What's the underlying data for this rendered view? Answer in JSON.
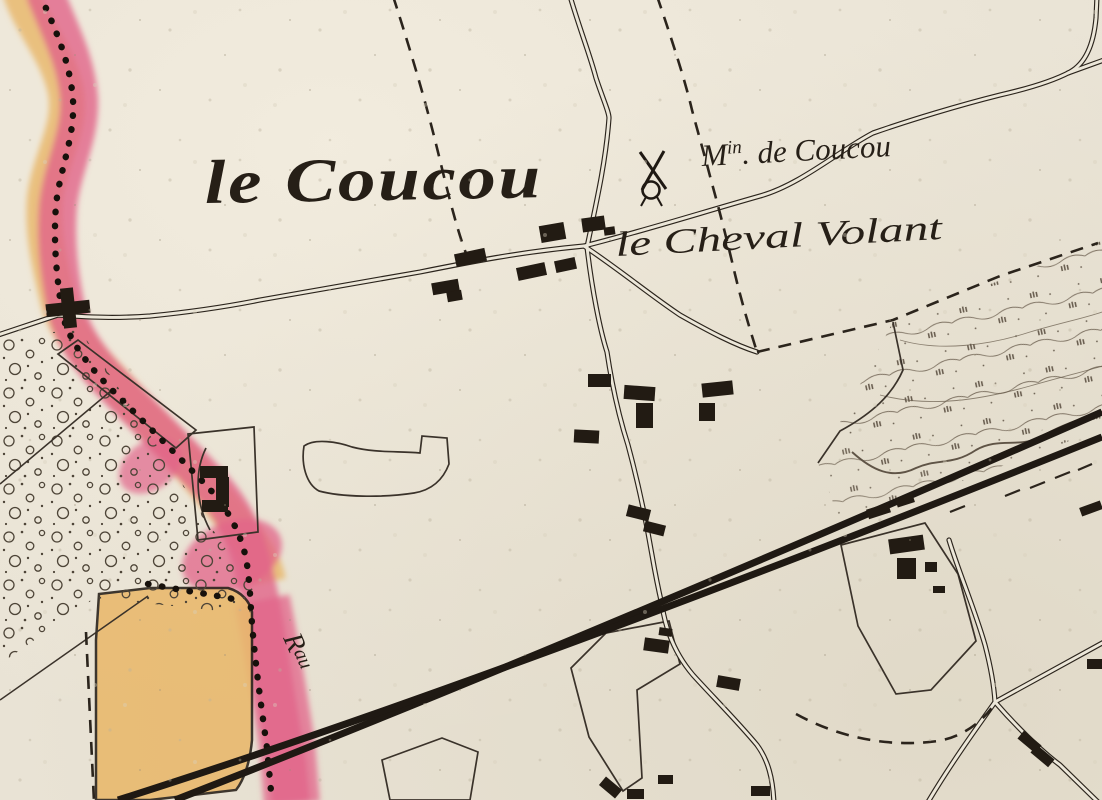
{
  "map": {
    "colors": {
      "paper": "#e9e3d5",
      "ink": "#2b241c",
      "pink": "#e1648a",
      "orange": "#e9b96e",
      "building": "#221b13"
    },
    "labels": {
      "locality": "le Coucou",
      "mill_prefix": "M",
      "mill_sup": "in",
      "mill_suffix": ". de Coucou",
      "hamlet": "le Cheval Volant",
      "stream_prefix": "R",
      "stream_sup": "au"
    },
    "symbols": [
      {
        "name": "windmill-icon"
      }
    ],
    "buildings": [
      [
        46,
        302,
        44,
        13,
        -6
      ],
      [
        62,
        288,
        13,
        40,
        -6
      ],
      [
        432,
        281,
        27,
        12,
        -10
      ],
      [
        447,
        291,
        15,
        10,
        -10
      ],
      [
        455,
        251,
        31,
        13,
        -12
      ],
      [
        517,
        265,
        29,
        13,
        -12
      ],
      [
        555,
        259,
        21,
        12,
        -12
      ],
      [
        540,
        224,
        25,
        17,
        -10
      ],
      [
        582,
        217,
        23,
        14,
        -8
      ],
      [
        604,
        227,
        11,
        8,
        -8
      ],
      [
        588,
        374,
        23,
        13,
        0
      ],
      [
        624,
        386,
        31,
        14,
        4
      ],
      [
        636,
        403,
        17,
        25,
        0
      ],
      [
        702,
        382,
        31,
        14,
        -6
      ],
      [
        699,
        403,
        16,
        18,
        0
      ],
      [
        574,
        430,
        25,
        13,
        3
      ],
      [
        627,
        507,
        23,
        12,
        14
      ],
      [
        644,
        523,
        21,
        11,
        14
      ],
      [
        717,
        677,
        23,
        12,
        10
      ],
      [
        644,
        639,
        25,
        13,
        8
      ],
      [
        659,
        628,
        13,
        8,
        8
      ],
      [
        889,
        537,
        35,
        15,
        -8
      ],
      [
        897,
        558,
        19,
        21,
        0
      ],
      [
        925,
        562,
        12,
        10,
        0
      ],
      [
        933,
        586,
        12,
        7,
        0
      ],
      [
        867,
        506,
        23,
        10,
        -18
      ],
      [
        896,
        496,
        18,
        9,
        -18
      ],
      [
        1018,
        737,
        23,
        10,
        40
      ],
      [
        1031,
        751,
        23,
        10,
        40
      ],
      [
        600,
        782,
        21,
        11,
        40
      ],
      [
        627,
        789,
        17,
        10,
        0
      ],
      [
        658,
        775,
        15,
        9,
        0
      ],
      [
        751,
        786,
        19,
        10,
        0
      ],
      [
        1087,
        659,
        15,
        10,
        0
      ],
      [
        1080,
        504,
        22,
        9,
        -20
      ],
      [
        200,
        466,
        28,
        12,
        0
      ],
      [
        216,
        477,
        13,
        30,
        0
      ],
      [
        202,
        500,
        26,
        12,
        0
      ]
    ]
  }
}
